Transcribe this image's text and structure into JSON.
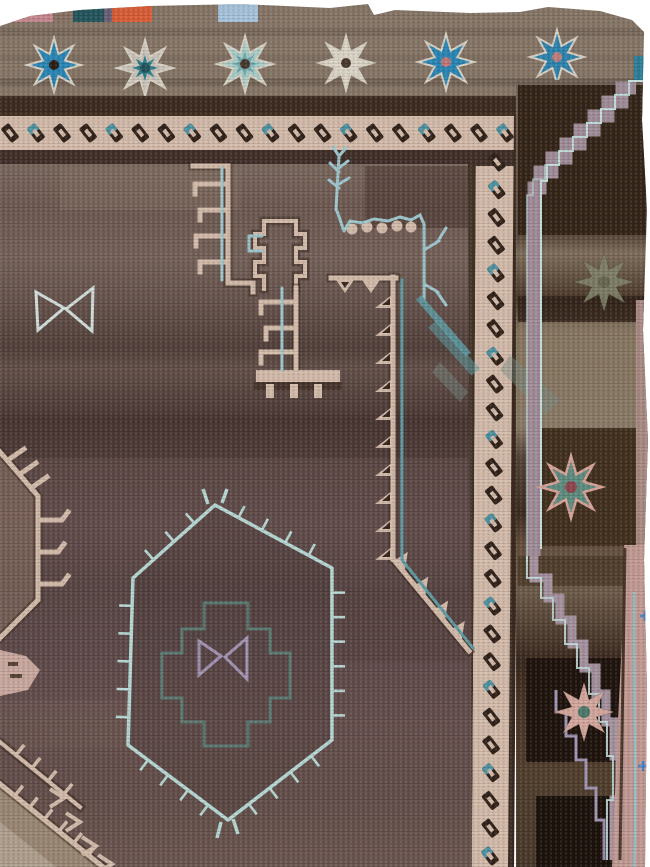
{
  "meta": {
    "type": "photograph",
    "subject": "antique Anatolian kilim rug fragment",
    "description": "Photograph of a corner of an antique brown Anatolian village rug: a grey-brown top band with blue, teal and ivory eight-pointed stars, a cream border with slanted dark dashes running along the top and right side, a purple-brown abrashed field with cream hooked latch motifs, pale blue branch and bowtie motifs, a pale blue ticked hexagonal medallion enclosing a teal stepped cross and lavender bowtie, and an outer right border with faded green, teal and pink stars, mauve stepped bands and a pink selvedge."
  },
  "palette": {
    "top_band": "#877768",
    "dark_band": "#3e2d21",
    "shadow_ink": "#3a2a20",
    "cream": "#d4bcab",
    "dash_dark": "#32231a",
    "dash_teal": "#4f93a3",
    "field_base": "#6b5852",
    "pale_blue": "#b7d8d4",
    "branch_blue": "#9fc8cf",
    "teal_line": "#5f9ca4",
    "cross_teal": "#5c7f76",
    "lavender_line": "#a494b4",
    "mauve_band": "#a18d99",
    "mauve_edge": "#c2dcda",
    "tan": "#9b8874",
    "tan_light": "#b3a392",
    "pink_blob": "#caa9a0",
    "pink_edge": "#c39b94",
    "pink_edge_line": "#96c2cc",
    "blue_plus": "#4a86c8",
    "outer_base": "#7c6c5f",
    "dark_patch": "#352619",
    "near_black": "#20140e",
    "star_halo": "#d8d2c4"
  },
  "top_patches": [
    {
      "x": 0,
      "w": 13,
      "color": "#7a2830"
    },
    {
      "x": 13,
      "w": 40,
      "color": "#c4888f"
    },
    {
      "x": 53,
      "w": 20,
      "color": "#8a7265"
    },
    {
      "x": 73,
      "w": 31,
      "color": "#25565e"
    },
    {
      "x": 104,
      "w": 8,
      "color": "#6b5f75"
    },
    {
      "x": 112,
      "w": 40,
      "color": "#d95f38"
    },
    {
      "x": 218,
      "w": 40,
      "color": "#a8c4dc"
    }
  ],
  "band_stars": [
    {
      "cx": 54,
      "cy": 65,
      "r": 27,
      "fill": "#2b87b5",
      "dot": "#2d2018"
    },
    {
      "cx": 145,
      "cy": 68,
      "r": 28,
      "fill": "#c9c3ba",
      "inner": {
        "r": 13,
        "fill": "#2e7d8a"
      },
      "dot": "#24555e"
    },
    {
      "cx": 245,
      "cy": 64,
      "r": 28,
      "fill": "#a9cdc9",
      "inner": {
        "r": 13,
        "fill": "#6fa9ad"
      },
      "dot": "#4a3a2e"
    },
    {
      "cx": 346,
      "cy": 63,
      "r": 27,
      "fill": "#ddd6c8",
      "dot": "#4a3a2e"
    },
    {
      "cx": 446,
      "cy": 62,
      "r": 28,
      "fill": "#2b87b5",
      "dot": "#c47878"
    },
    {
      "cx": 557,
      "cy": 57,
      "r": 27,
      "fill": "#2f84ae",
      "dot": "#c08080"
    }
  ],
  "border_stars": [
    {
      "cx": 604,
      "cy": 282,
      "r": 30,
      "fill": "#84866d",
      "dot": "#6b6d55",
      "outline": "none",
      "opacity": 0.85
    },
    {
      "cx": 571,
      "cy": 487,
      "r": 31,
      "fill": "#5f8d80",
      "dot": "#8f4750",
      "outline": "#d8a49a",
      "opacity": 1
    },
    {
      "cx": 584,
      "cy": 712,
      "r": 30,
      "fill": "#d4a89e",
      "dot": "#4e7a6e",
      "outline": "none",
      "opacity": 1
    }
  ],
  "dash_border": {
    "top": {
      "x0": 10,
      "x1": 505,
      "y": 133,
      "count": 20
    },
    "right": {
      "y0": 162,
      "y1": 856,
      "x_top": 497,
      "x_bottom": 490,
      "count": 26
    },
    "rotation": -38,
    "teal_every": 3
  },
  "hexagon": {
    "points": [
      [
        215,
        505
      ],
      [
        133,
        578
      ],
      [
        128,
        745
      ],
      [
        228,
        820
      ],
      [
        332,
        740
      ],
      [
        332,
        568
      ]
    ],
    "tick_spacing": 26,
    "tick_len": 13
  },
  "sawtooth": {
    "spine_x": 393,
    "y0": 294,
    "y1": 546,
    "step": 28,
    "tooth": 14,
    "diag": {
      "x0": 393,
      "y0": 559,
      "x1": 469,
      "y1": 651,
      "ts": [
        0.15,
        0.42,
        0.68,
        0.9
      ]
    }
  },
  "bottom_left": {
    "diag1": {
      "x0": 0,
      "y0": 784,
      "x1": 103,
      "y1": 867,
      "ticks": 6
    },
    "diag2": {
      "x0": 0,
      "y0": 742,
      "x1": 80,
      "y1": 807,
      "ticks": 4
    },
    "chevrons": [
      [
        64,
        798
      ],
      [
        80,
        822
      ],
      [
        96,
        846
      ],
      [
        112,
        864
      ]
    ]
  }
}
